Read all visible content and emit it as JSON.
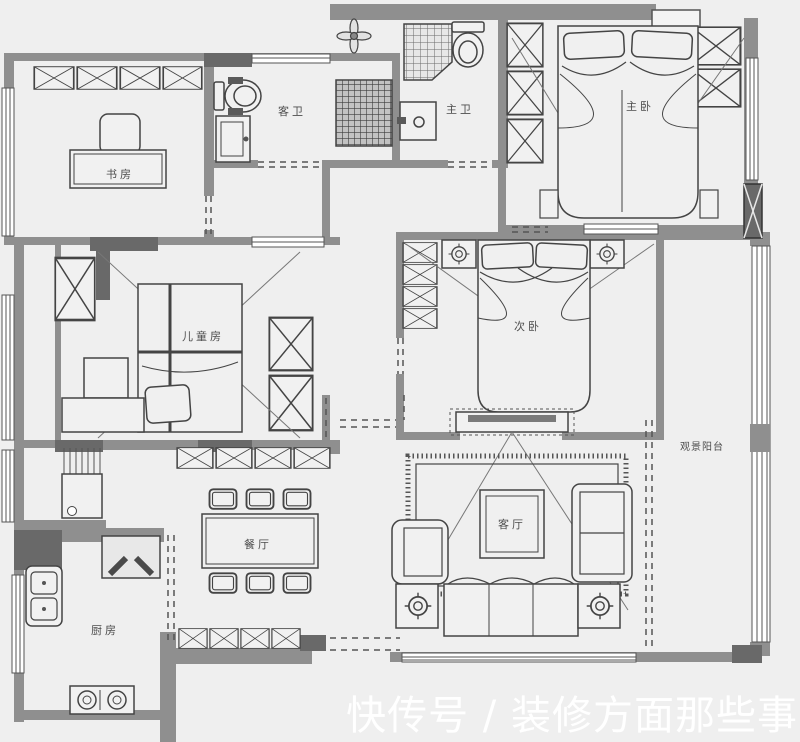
{
  "colors": {
    "background": "#efefef",
    "wall": "#8f8f8f",
    "wall_dark": "#696969",
    "line": "#444444",
    "label": "#4d4d4d",
    "watermark": "#ffffff"
  },
  "rooms": {
    "study": {
      "label": "书房"
    },
    "guest_bath": {
      "label": "客卫"
    },
    "master_bath": {
      "label": "主卫"
    },
    "master_bedroom": {
      "label": "主卧"
    },
    "second_bedroom": {
      "label": "次卧"
    },
    "kids_room": {
      "label": "儿童房"
    },
    "dining": {
      "label": "餐厅"
    },
    "living": {
      "label": "客厅"
    },
    "kitchen": {
      "label": "厨房"
    },
    "balcony": {
      "label": "观景阳台"
    }
  },
  "watermark": {
    "text": "快传号 / 装修方面那些事"
  }
}
